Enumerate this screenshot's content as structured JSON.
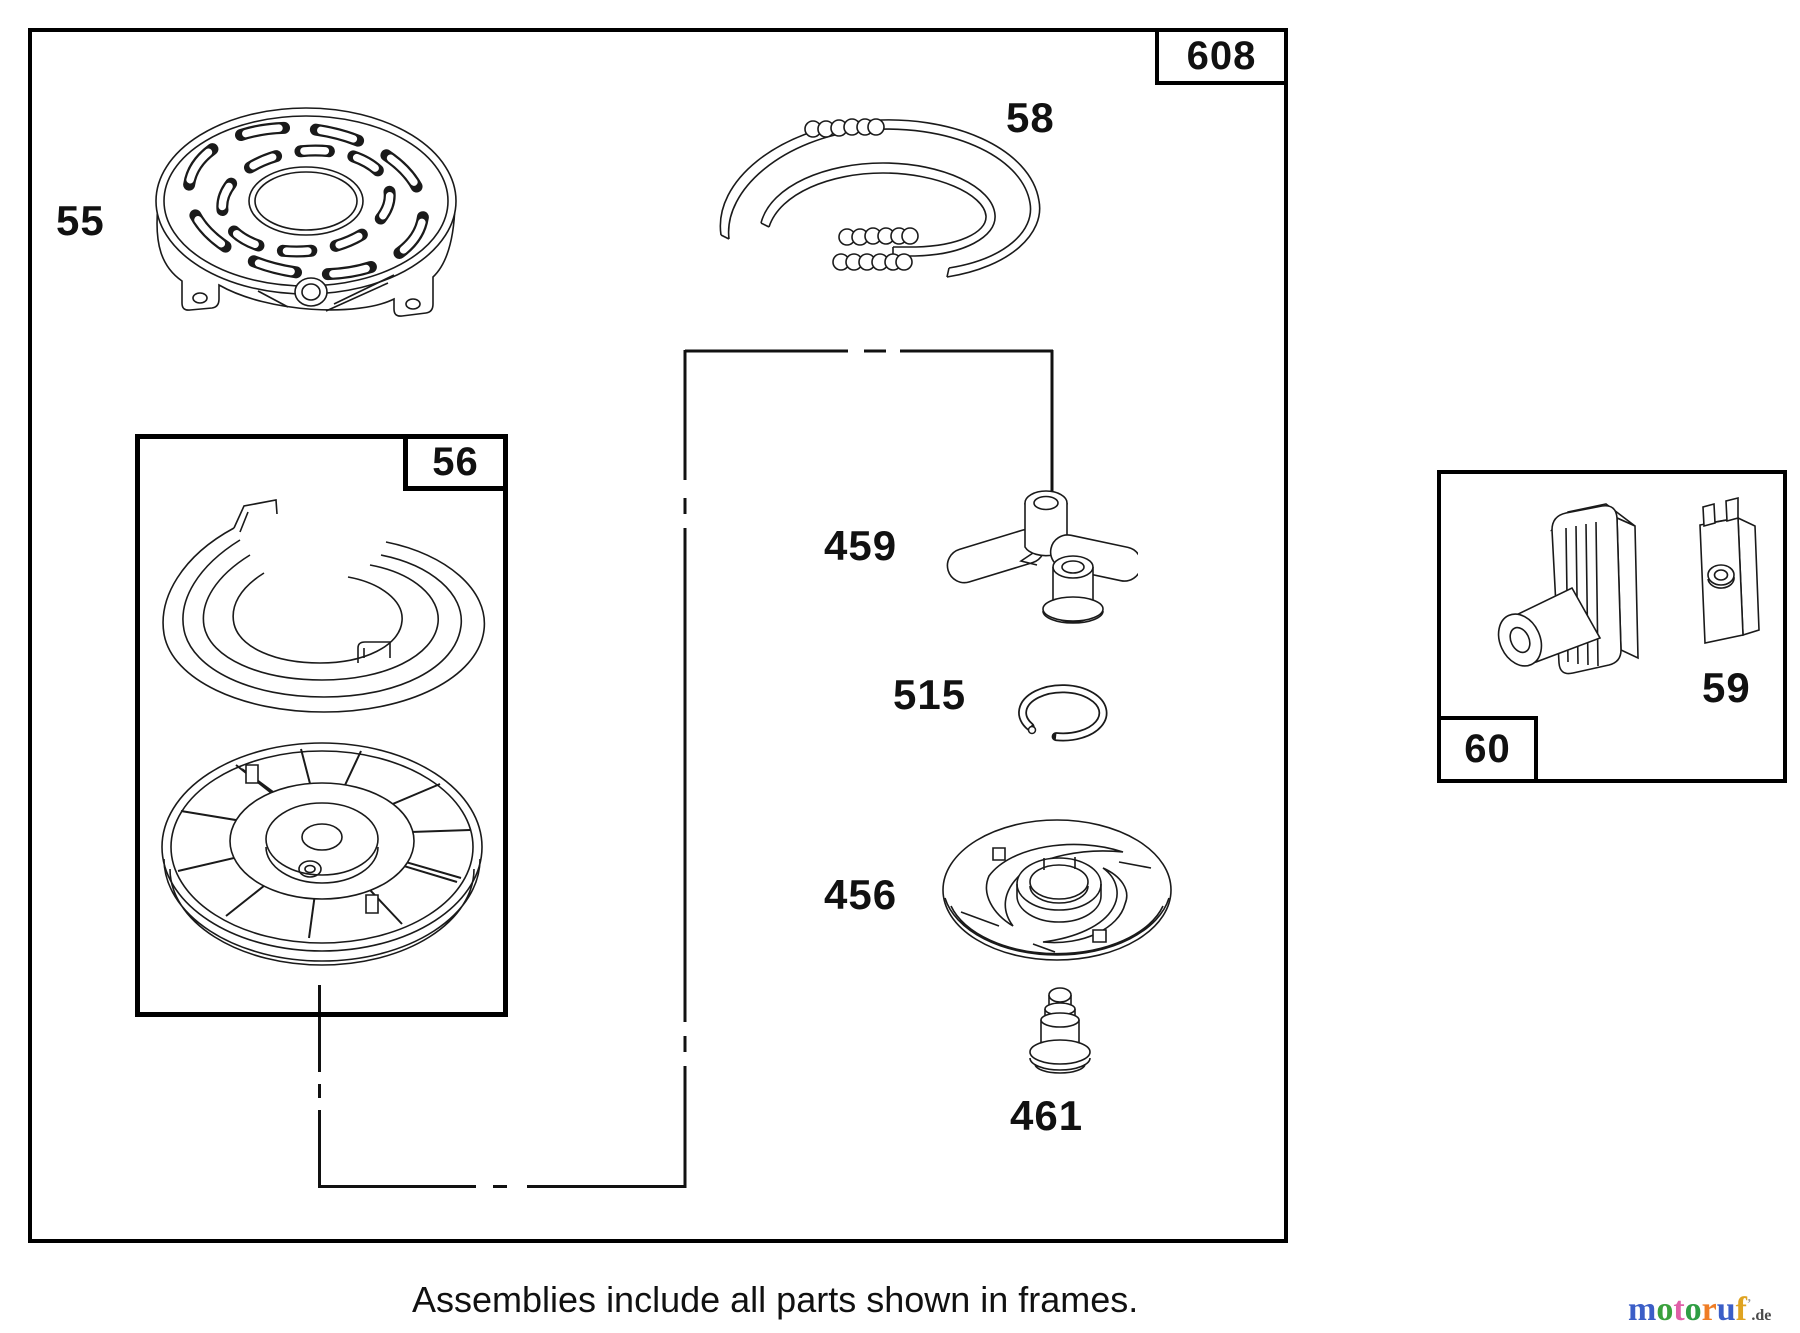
{
  "diagram": {
    "main_frame": {
      "label": "608"
    },
    "frames": [
      {
        "label": "56"
      },
      {
        "label": "60"
      }
    ],
    "parts": [
      {
        "id": "55"
      },
      {
        "id": "58"
      },
      {
        "id": "459"
      },
      {
        "id": "515"
      },
      {
        "id": "456"
      },
      {
        "id": "461"
      },
      {
        "id": "59"
      }
    ],
    "caption": "Assemblies include all parts shown in frames.",
    "line_color": "#1a1a1a",
    "background": "#ffffff"
  },
  "watermark": {
    "word": "motoruf",
    "letters": [
      {
        "char": "m",
        "color": "#3b5ec7"
      },
      {
        "char": "o",
        "color": "#3aa13c"
      },
      {
        "char": "t",
        "color": "#e05fa8"
      },
      {
        "char": "o",
        "color": "#2f9e44"
      },
      {
        "char": "r",
        "color": "#ef7d25"
      },
      {
        "char": "u",
        "color": "#3b5ec7"
      },
      {
        "char": "f",
        "color": "#dfa321"
      }
    ],
    "mark": "’",
    "mark_color": "#9a9a9a",
    "suffix": ".de",
    "suffix_color": "#4a4a4a"
  }
}
